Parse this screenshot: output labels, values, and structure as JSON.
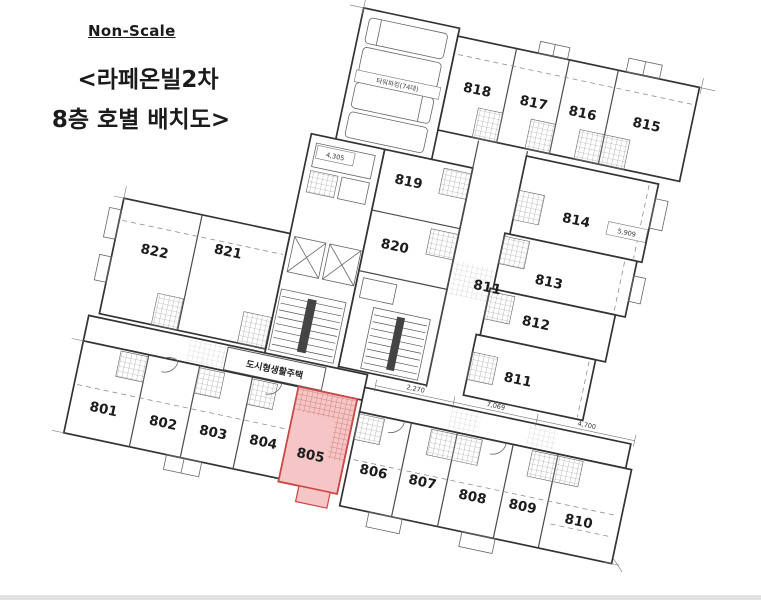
{
  "title": {
    "non_scale": "Non-Scale",
    "line1": "<라페온빌2차",
    "line2": "8층 호별 배치도>"
  },
  "annotations": {
    "parking": "타워파킹(74대)",
    "corridor_sign": "도시형생활주택"
  },
  "dimensions": {
    "left": "4,305",
    "right": "5,909",
    "bottom_a": "2,270",
    "bottom_b": "7,069",
    "bottom_c": "4,700"
  },
  "highlight": {
    "unit": "805",
    "fill": "#f6c5c5",
    "stroke": "#cf4646",
    "label_color": "#c0272c"
  },
  "units": [
    {
      "label": "801"
    },
    {
      "label": "802"
    },
    {
      "label": "803"
    },
    {
      "label": "804"
    },
    {
      "label": "805"
    },
    {
      "label": "806"
    },
    {
      "label": "807"
    },
    {
      "label": "808"
    },
    {
      "label": "809"
    },
    {
      "label": "810"
    },
    {
      "label": "811"
    },
    {
      "label": "811"
    },
    {
      "label": "812"
    },
    {
      "label": "813"
    },
    {
      "label": "814"
    },
    {
      "label": "815"
    },
    {
      "label": "816"
    },
    {
      "label": "817"
    },
    {
      "label": "818"
    },
    {
      "label": "819"
    },
    {
      "label": "820"
    },
    {
      "label": "821"
    },
    {
      "label": "822"
    }
  ]
}
